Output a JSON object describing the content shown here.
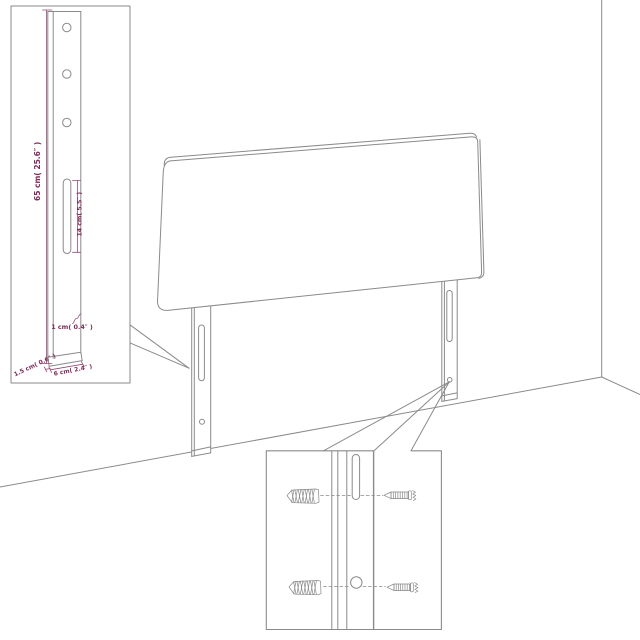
{
  "diagram": {
    "subject": "headboard-assembly-diagram",
    "colors": {
      "line": "#8a8a8a",
      "dimension": "#7d2b57",
      "background": "#ffffff"
    }
  },
  "insets": {
    "leg_detail": {
      "height_label": "65 cm( 25.6″ )",
      "slot_label": "14 cm( 5.5″ )",
      "lip_label": "1 cm( 0.4″ )",
      "depth_label": "1.5 cm( 0.6″ )",
      "width_label": "6 cm( 2.4″ )"
    },
    "hardware_detail": {
      "icons": [
        "anchor-screw-icon",
        "anchor-screw-icon",
        "wood-screw-icon",
        "wood-screw-icon"
      ]
    }
  }
}
